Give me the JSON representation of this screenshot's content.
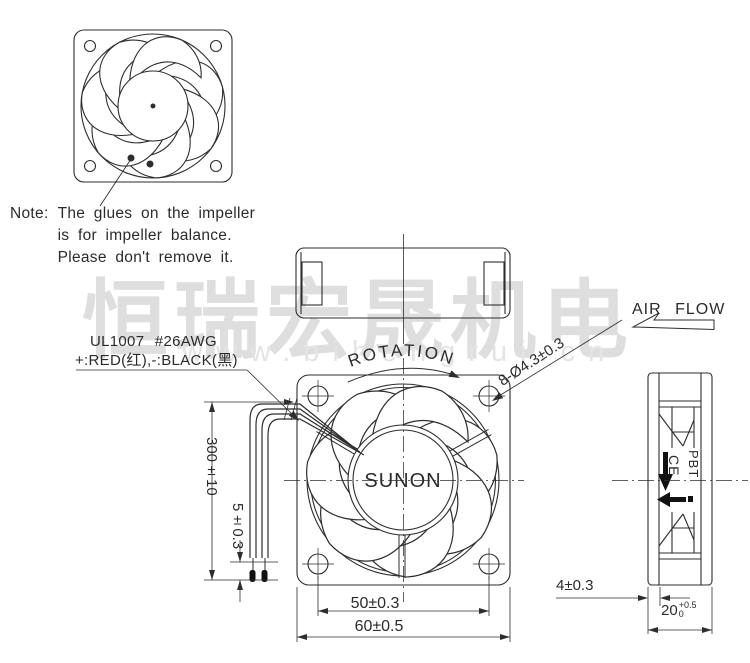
{
  "watermark": {
    "chinese": "恒瑞宏晟机电",
    "url": "www.bihengrui.cn"
  },
  "note": {
    "prefix": "Note:",
    "line1": "The glues on the impeller",
    "line2": "is for impeller balance.",
    "line3": "Please don't remove it."
  },
  "labels": {
    "wire_spec": "UL1007 #26AWG",
    "wire_polarity": "+:RED(红),-:BLACK(黑)",
    "rotation": "ROTATION",
    "air_flow": "AIR FLOW",
    "brand": "SUNON",
    "material": "PBT",
    "ce_mark": "CE",
    "mounting_holes": "8-Ø4.3±0.3"
  },
  "dimensions": {
    "wire_length": "300±10",
    "strip_length": "5±0.3",
    "hole_pitch": "50±0.3",
    "frame_size": "60±0.5",
    "flange_thickness": "4±0.3",
    "depth": "20",
    "depth_tol_upper": "+0.5",
    "depth_tol_lower": "0"
  },
  "colors": {
    "line": "#2e2e2e",
    "black": "#111111",
    "watermark_chinese": "#d6d6d6",
    "watermark_url": "#e4e4e4"
  }
}
